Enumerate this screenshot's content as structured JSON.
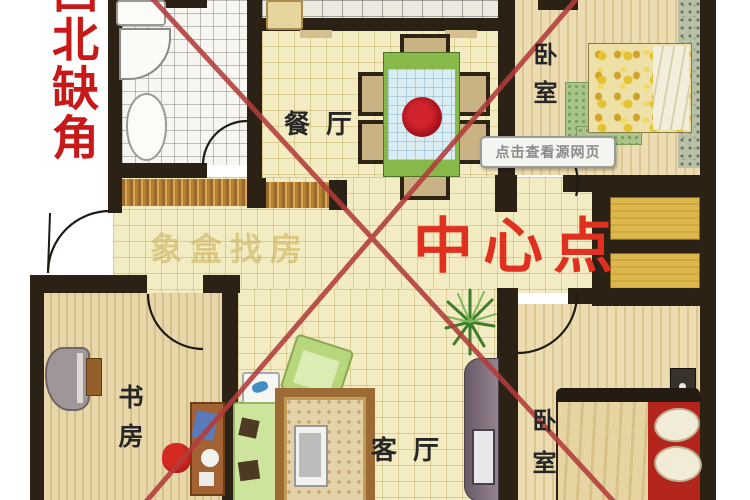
{
  "labels": {
    "corner_warning": "西北缺角",
    "center_point": "中心点",
    "tooltip": "点击查看源网页",
    "watermark": "象盒找房",
    "dining": "餐厅",
    "bedroom_top": "卧室",
    "bedroom_bottom": "卧室",
    "study": "书房",
    "living": "客厅"
  },
  "colors": {
    "warning_text": "#c81818",
    "center_point_text": "#e03020",
    "cross_lines": "#b23c3a",
    "walls": "#2b2115",
    "tile_floor": "#f3ecc2",
    "wood_floor": "#e8d7aa",
    "bay_window": "#dcb74e"
  }
}
